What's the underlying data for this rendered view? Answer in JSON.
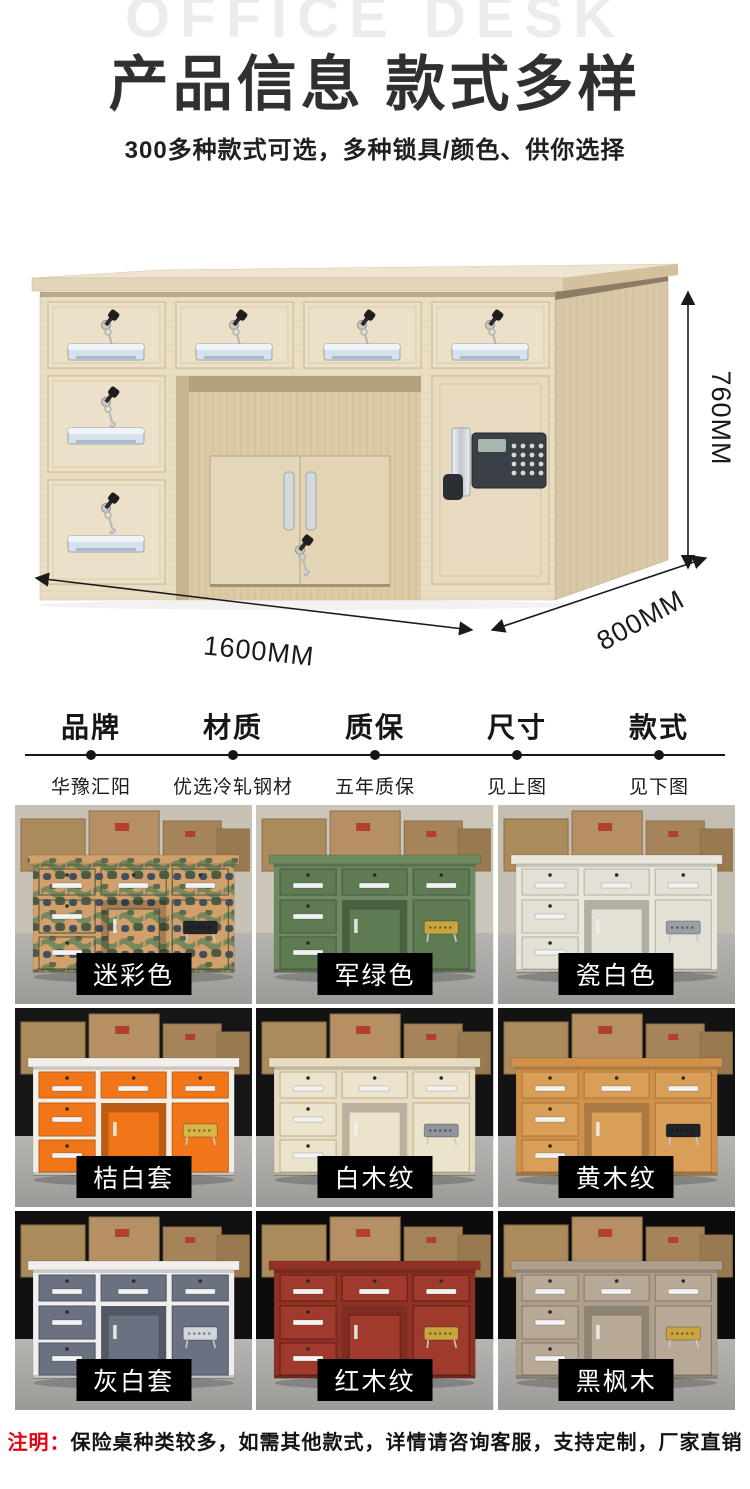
{
  "header": {
    "watermark": "OFFICE DESK",
    "title": "产品信息 款式多样",
    "subtitle": "300多种款式可选，多种锁具/颜色、供你选择"
  },
  "hero": {
    "dim_height": "760MM",
    "dim_width": "1600MM",
    "dim_depth": "800MM"
  },
  "specs": {
    "columns": [
      {
        "label": "品牌",
        "value": "华豫汇阳"
      },
      {
        "label": "材质",
        "value": "优选冷轧钢材"
      },
      {
        "label": "质保",
        "value": "五年质保"
      },
      {
        "label": "尺寸",
        "value": "见上图"
      },
      {
        "label": "款式",
        "value": "见下图"
      }
    ]
  },
  "grid": {
    "items": [
      {
        "label": "迷彩色"
      },
      {
        "label": "军绿色"
      },
      {
        "label": "瓷白色"
      },
      {
        "label": "桔白套"
      },
      {
        "label": "白木纹"
      },
      {
        "label": "黄木纹"
      },
      {
        "label": "灰白套"
      },
      {
        "label": "红木纹"
      },
      {
        "label": "黑枫木"
      }
    ]
  },
  "note": {
    "prefix": "注明：",
    "text": "保险桌种类较多，如需其他款式，详情请咨询客服，支持定制，厂家直销"
  },
  "colors": {
    "accent_red": "#e60012",
    "title_color": "#303030",
    "watermark_gray": "#ececec",
    "label_bg": "#000000",
    "label_text": "#ffffff"
  }
}
